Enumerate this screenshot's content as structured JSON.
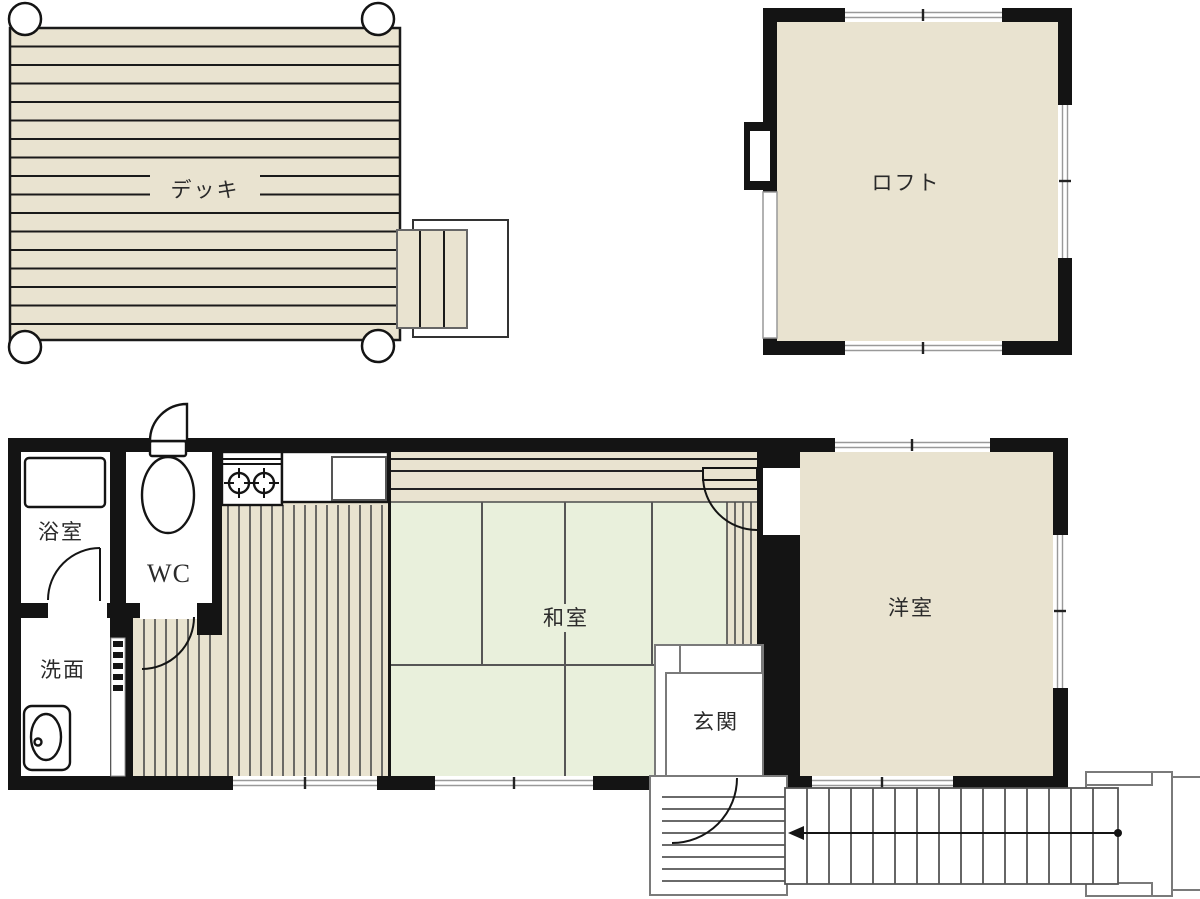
{
  "floorplan": {
    "title": "house-floorplan",
    "deck": {
      "label": "デッキ"
    },
    "loft": {
      "label": "ロフト"
    },
    "rooms": {
      "bath": {
        "label": "浴室"
      },
      "wc": {
        "label": "WC"
      },
      "washroom": {
        "label": "洗面"
      },
      "tatami": {
        "label": "和室"
      },
      "entrance": {
        "label": "玄関"
      },
      "western": {
        "label": "洋室"
      }
    },
    "colors": {
      "wall": "#141414",
      "wood": "#e9e3d0",
      "tatami_green": "#e9f0dc",
      "background": "#ffffff"
    }
  }
}
